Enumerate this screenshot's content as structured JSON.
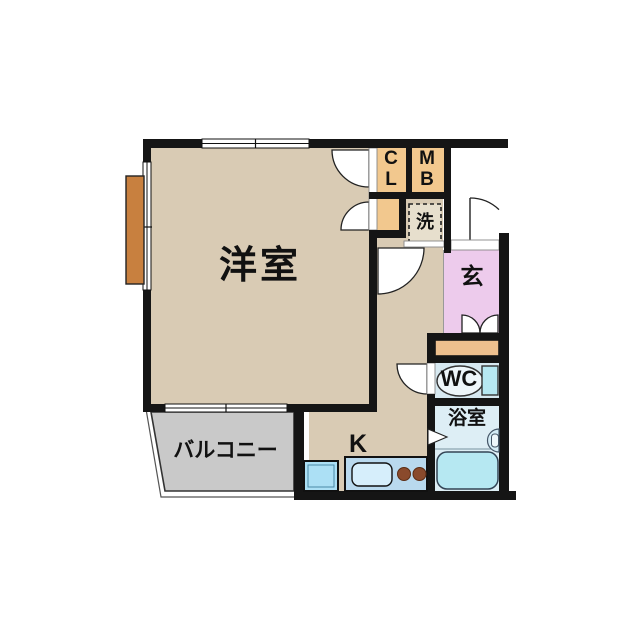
{
  "floorplan": {
    "type": "apartment-floor-plan",
    "rooms": {
      "western_room": {
        "label": "洋室"
      },
      "balcony": {
        "label": "バルコニー"
      },
      "kitchen": {
        "label": "K"
      },
      "closet": {
        "label": "CL"
      },
      "meter_box": {
        "label": "MB"
      },
      "laundry": {
        "label": "洗"
      },
      "entrance": {
        "label": "玄"
      },
      "toilet": {
        "label": "WC"
      },
      "bathroom": {
        "label": "浴室"
      }
    },
    "colors": {
      "wall": "#151515",
      "floor_tan": "#d9cbb4",
      "closet_orange": "#f2c88e",
      "porch_orange": "#eec08e",
      "shutter_brown": "#c8803f",
      "entrance_pink": "#edcbec",
      "wc_floor": "#d7e9f1",
      "bath_floor": "#ddeef5",
      "fixture_cyan": "#b6e8f2",
      "sink_blue": "#d6eefb",
      "counter_blue": "#b9d9ee",
      "fridge_blue": "#ace0f5",
      "balcony_gray": "#c9c9c9",
      "burner_brown": "#8a4a2c",
      "laundry_box": "#e7dfcd"
    }
  }
}
